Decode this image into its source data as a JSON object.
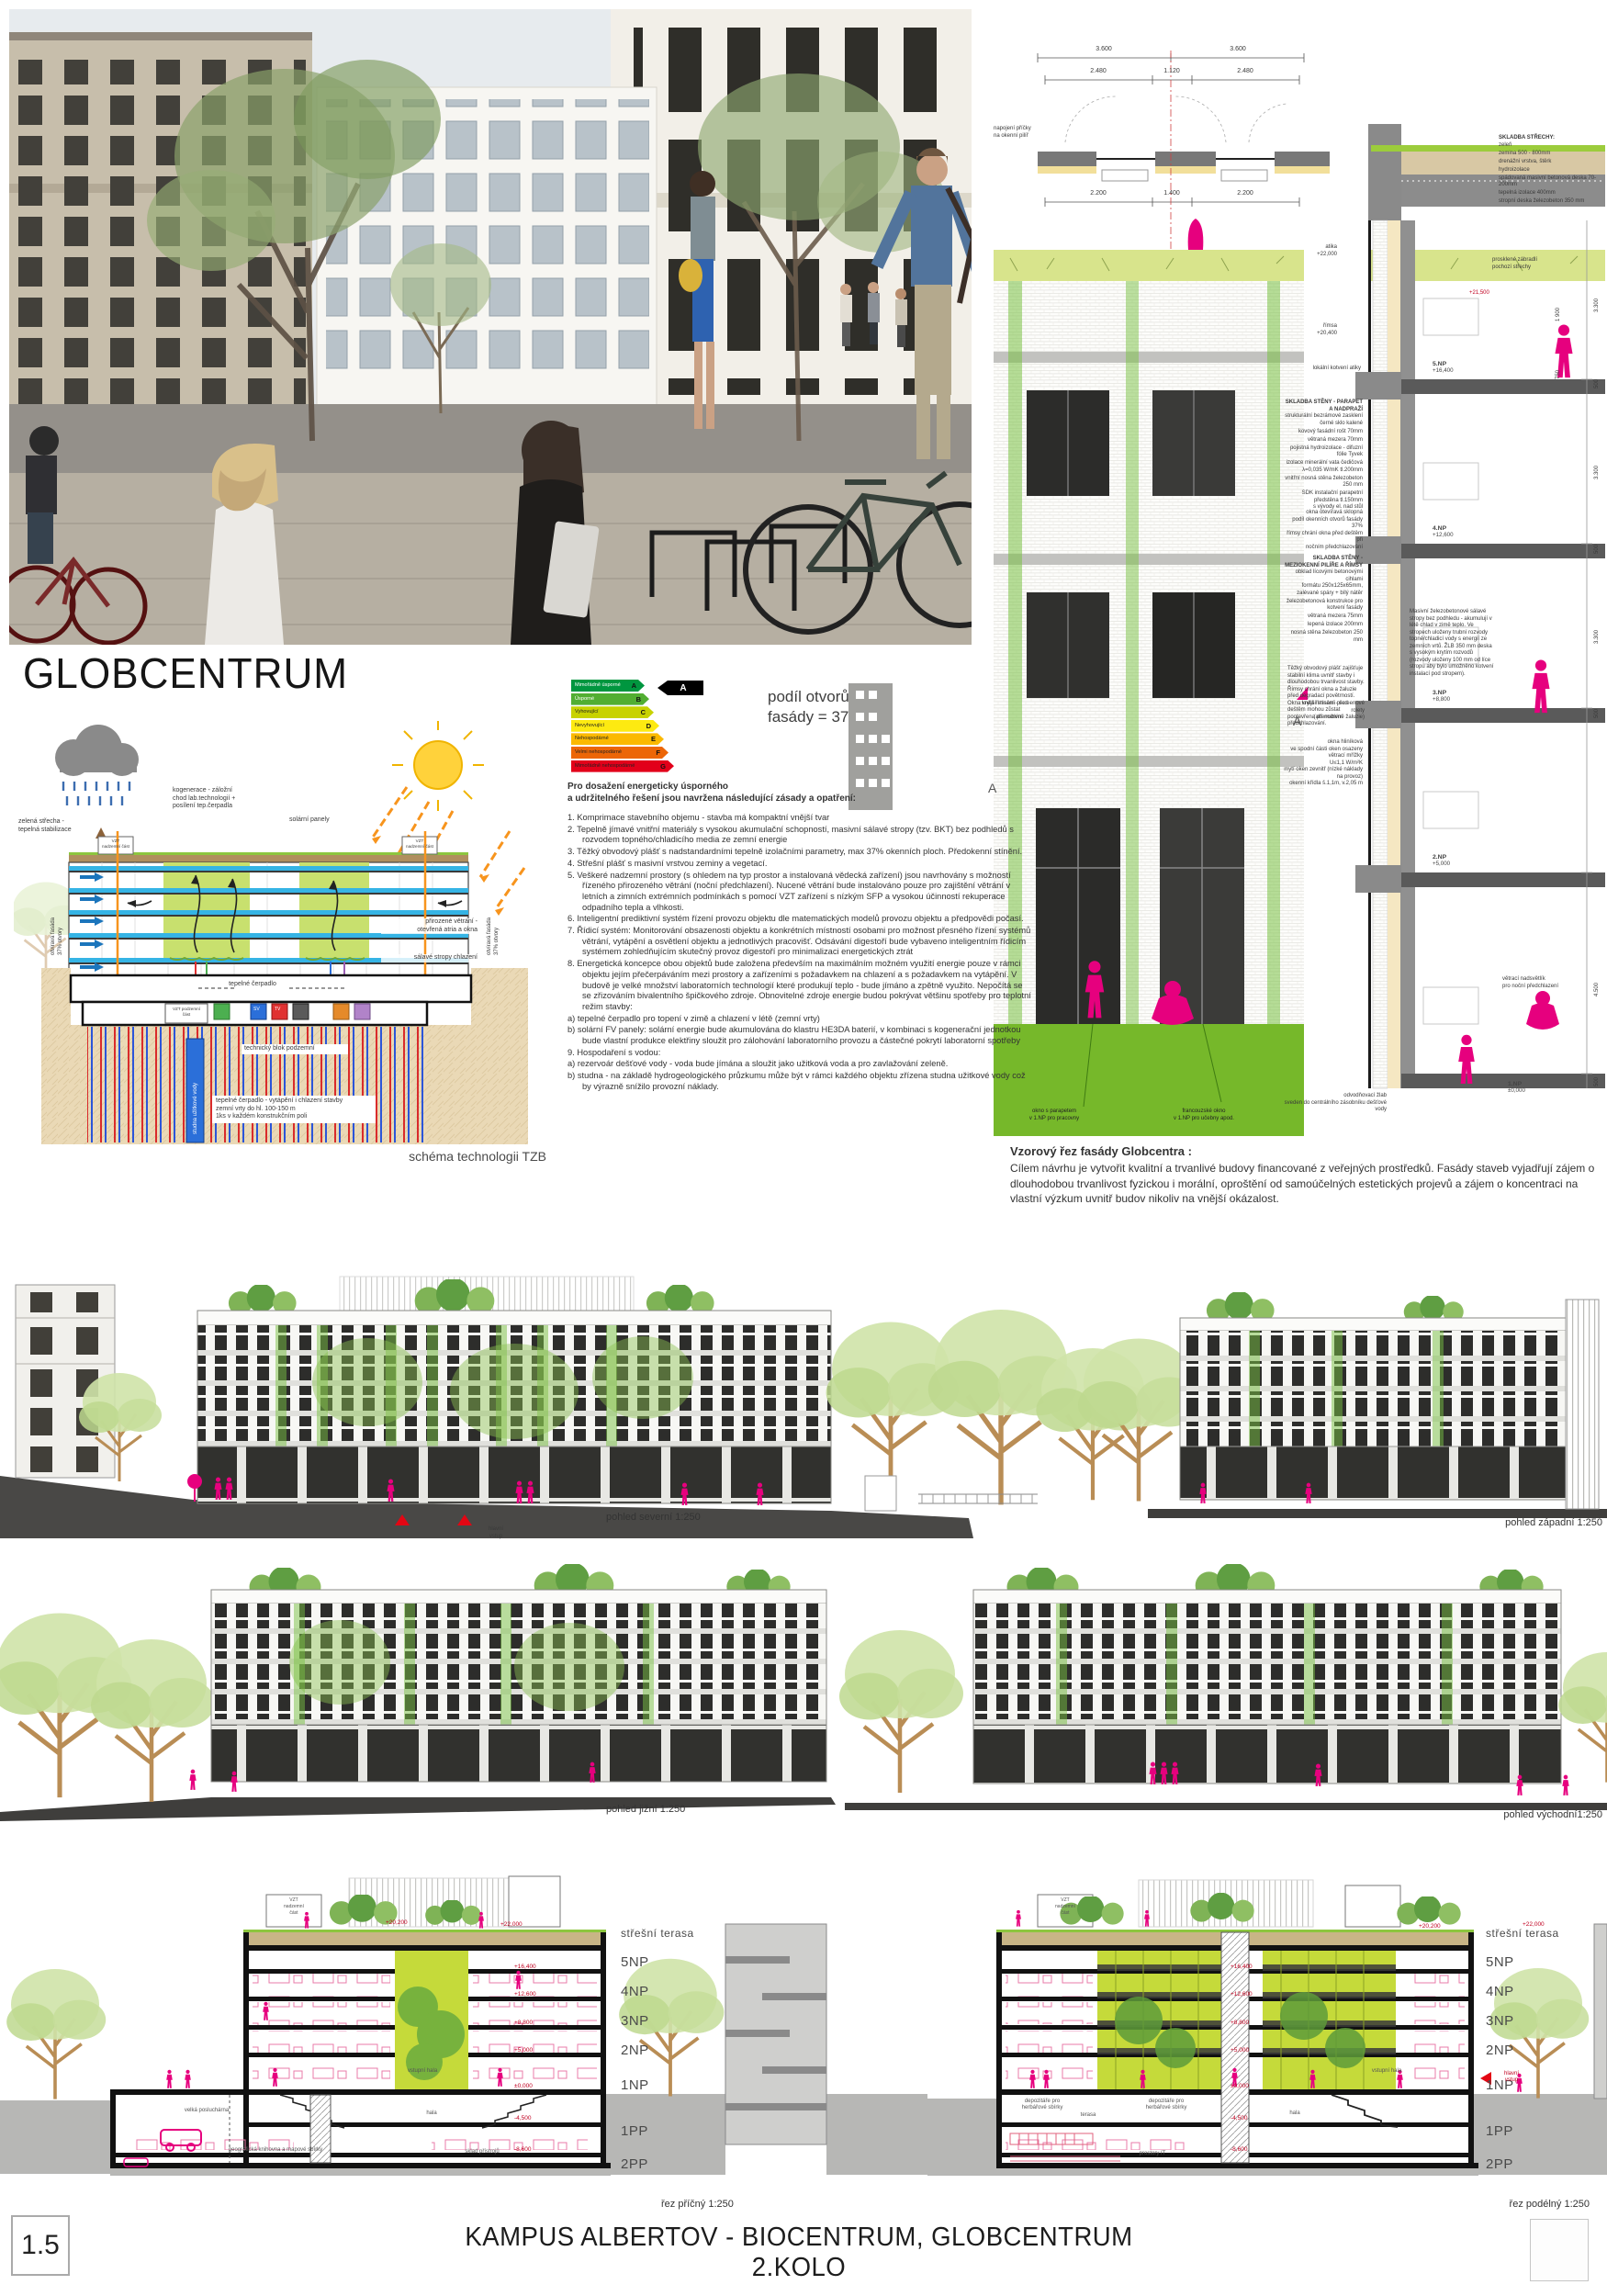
{
  "colors": {
    "accent_pink": "#e6007e",
    "grass_green": "#76b82a",
    "atrium_green": "#c5da3a",
    "tech_blue": "#35b4e5"
  },
  "board": {
    "page_number": "1.5",
    "title_line1": "KAMPUS ALBERTOV - BIOCENTRUM, GLOBCENTRUM",
    "title_line2": "2.KOLO"
  },
  "photo": {
    "sign": "GLOBCENTRUM"
  },
  "globcentrum_title": "GLOBCENTRUM",
  "energy_label": {
    "pointer_letter": "A",
    "rows": [
      {
        "label": "Mimořádně úsporné",
        "letter": "A",
        "color": "#00963f",
        "w": 80
      },
      {
        "label": "Úsporné",
        "letter": "B",
        "color": "#52ae32",
        "w": 85
      },
      {
        "label": "Vyhovující",
        "letter": "C",
        "color": "#c8d200",
        "w": 90
      },
      {
        "label": "Nevyhovující",
        "letter": "D",
        "color": "#fdea11",
        "w": 96
      },
      {
        "label": "Nehospodárné",
        "letter": "E",
        "color": "#fbb900",
        "w": 101
      },
      {
        "label": "Velmi nehospodárné",
        "letter": "F",
        "color": "#ec6607",
        "w": 106
      },
      {
        "label": "Mimořádně nehospodárné",
        "letter": "G",
        "color": "#e2001a",
        "w": 112
      }
    ]
  },
  "facade_share": {
    "line1": "podíl otvorů",
    "line2": "fasády = 37%"
  },
  "energy_text": {
    "heading_line1": "Pro dosažení energeticky úsporného",
    "heading_line2": "a udržitelného řešení jsou navržena následující zásady a opatření:",
    "items": [
      "1.  Komprimace stavebního objemu - stavba má kompaktní vnější tvar",
      "2.  Tepelně jímavé vnitřní materiály s vysokou akumulační schopností, masivní sálavé stropy (tzv. BKT) bez podhledů s rozvodem topného/chladicího media ze zemní energie",
      "3.  Těžký obvodový plášť s nadstandardními tepelně izolačními parametry, max 37% okenních ploch. Předokenní stínění.",
      "4.  Střešní plášť s masivní vrstvou zeminy a vegetací.",
      "5.  Veškeré nadzemní prostory (s ohledem na typ prostor a instalovaná vědecká zařízení) jsou navrhovány s možností řízeného přirozeného větrání (noční předchlazení). Nucené větrání bude instalováno pouze pro zajištění větrání v letních a zimních extrémních podmínkách s pomocí VZT zařízení s nízkým SFP a vysokou účinností rekuperace odpadního tepla a vlhkosti.",
      "6.  Inteligentní prediktivní systém řízení provozu objektu dle matematických modelů provozu objektu a předpovědi počasí.",
      "7.  Řídicí systém: Monitorování obsazenosti objektu a konkrétních místností osobami pro možnost přesného řízení systémů větrání, vytápění a osvětlení objektu a jednotlivých pracovišť. Odsávání digestoří bude vybaveno inteligentním řídicím systémem zohledňujícím skutečný provoz digestoří pro minimalizaci energetických ztrát",
      "8.  Energetická koncepce obou objektů bude založena především na maximálním možném využití energie pouze v rámci objektu jejím přečerpáváním mezi prostory a zařízeními s požadavkem na chlazení a s požadavkem na vytápění. V budově je velké množství laboratorních technologií které produkují teplo - bude jímáno a zpětně využito. Nepočítá se se zřizováním bivalentního špičkového zdroje. Obnovitelné zdroje energie budou pokrývat většinu spotřeby pro teplotní režim stavby:",
      "a) tepelné čerpadlo pro topení v zimě a chlazení v létě (zemní vrty)",
      "b) solární FV panely: solární energie bude akumulována do klastru HE3DA baterií, v kombinaci s kogenerační jednotkou bude vlastní produkce elektřiny sloužit pro zálohování laboratorního provozu a částečné pokrytí laboratorní spotřeby",
      "9.  Hospodaření s vodou:",
      "a) rezervoár dešťové vody - voda bude jímána a sloužit jako užitková voda a pro zavlažování zeleně.",
      "b) studna - na základě hydrogeologického průzkumu může být v rámci každého objektu zřízena studna užitkové vody což by výrazně snížilo provozní náklady."
    ]
  },
  "tzb": {
    "caption": "schéma technologii TZB",
    "green_roof": "zelená střecha -\ntepelná stabilizace",
    "cogen": "kogenerace - záložní\nchod lab.technologií +\nposílení tep.čerpadla",
    "solar": "solární panely",
    "vzt_top": "VZT\nnadzemní část",
    "nat_vent": "přirozené větrání -\notevřená atria a okna",
    "slabs": "sálavé stropy chlazení",
    "heat_pump": "tepelné čerpadlo",
    "vzt_bottom": "VZT podzemní\nčást",
    "tech_block": "technický blok podzemní",
    "well": "studna užitkové vody",
    "boreholes": "tepelné čerpadlo - vytápění i chlazení stavby\nzemní vrty do hl. 100-150 m\n1ks v každém konstrukčním poli",
    "facade_side": "otvíravá fasáda\n37% otvory",
    "box_sv": "SV",
    "box_tv": "TV"
  },
  "facade_detail": {
    "plan": {
      "dims_row1": [
        "3.600",
        "3.600"
      ],
      "dims_row2": [
        "2.480",
        "1.120",
        "2.480"
      ],
      "dims_row3": [
        "2.200",
        "1.400",
        "2.200"
      ],
      "note": "napojení příčky\nna okenní pilíř"
    },
    "roof": {
      "title": "SKLADBA STŘECHY:",
      "layers": [
        "zeleň",
        "zemina 500 - 800mm",
        "drenážní vrstva, štěrk",
        "hydroizolace",
        "spádovaná masivní betonová deska 70-200mm",
        "tepelná izolace 400mm",
        "stropní deska železobeton 350 mm"
      ]
    },
    "parapet_note": "prosklené zábradlí\npochozí střechy",
    "terrace_level": "+21,500",
    "anchor_note": "lokální kotvení atiky",
    "levels": {
      "atika": {
        "name": "atika",
        "value": "+22,000"
      },
      "rimsa": {
        "name": "římsa",
        "value": "+20,400"
      },
      "np5": {
        "name": "5.NP",
        "value": "+16,400"
      },
      "np4": {
        "name": "4.NP",
        "value": "+12,600"
      },
      "np3": {
        "name": "3.NP",
        "value": "+8,800"
      },
      "np2": {
        "name": "2.NP",
        "value": "+5,000"
      },
      "np1": {
        "name": "1.NP",
        "value": "±0,000"
      }
    },
    "wall1": {
      "title": "SKLADBA STĚNY - PARAPET A NADPRAŽÍ",
      "layers": [
        "strukturální bezrámové zasklení\nčerné sklo kalené",
        "kovový fasádní rošt 70mm",
        "větraná mezera 70mm",
        "pojistná hydroizolace - difuzní fólie Tyvek",
        "izolace minerální vata čedičová\nλ=0,035 W/mK tl.200mm",
        "vnitřní nosná stěna železobeton 250 mm",
        "SDK instalační parapetní předstěna tl.150mm\ns vývody el. nad stůl"
      ]
    },
    "window_note": "okna otevíravá sklopná\npodíl okenních otvorů fasády 37%\nřímsy chrání okna před deštěm při\nnočním předchlazování",
    "wall2": {
      "title": "SKLADBA STĚNY -\nMEZIOKENNÍ PILÍŘE A ŘÍMSY",
      "layers": [
        "obklad lícovými betonovými cihlami\nformátu 250x125x65mm,\nzalévané spáry + bílý nátěr",
        "železobetonová konstrukce pro kotvení fasády",
        "větraná mezera 75mm",
        "lepená izolace 200mm",
        "nosná stěna železobeton 250 mm"
      ]
    },
    "envelope_note": "Těžký obvodový plášť zajišťuje stabilní klima uvnitř stavby i dlouhodobou trvanlivost stavby. Římsy chrání okna a žaluzie před degradací povětrností. Okna krytá římsami před deštěm mohou zůstat pootevřena při nočním předchlazování.",
    "slab_note": "Masivní železobetonové sálavé stropy bez podhledu - akumulují v létě chlad v zimě teplo. Ve stropech uloženy trubní rozvody topné/chladicí vody s energií ze zemních vrtů. ŽLB 350 mm deska s vysokým krytím rozvodů (rozvody uloženy 100 mm od líce stropu aby bylo umožněno kotvení instalací pod stropem).",
    "shading_note": "vnější stínění - screenové rolety\n(alternativně žaluzie)",
    "window_spec": "okna hliníková\nve spodní části oken osazeny větrací mřížky\nU≤1,1 W/m²K\nmytí oken zevnitř (nízké náklady na provoz)\nokenní křídla š.1,1m, v.2,05 m",
    "vent_note": "větrací nadsvětlík\npro noční předchlazení",
    "drain_note": "odvodňovací žlab\nsveden do centrálního zásobníku dešťové vody",
    "ground_notes": [
      "okno s parapetem\nv 1.NP pro pracovny",
      "francouzské okno\nv 1.NP pro učebny apod."
    ],
    "section_marker": "A",
    "dims_right": [
      "3.300",
      "500",
      "3.300",
      "500",
      "3.300",
      "500",
      "4.500",
      "500"
    ],
    "dims_small": [
      "1 900",
      "750"
    ]
  },
  "vzor_text": {
    "heading": "Vzorový řez fasády Globcentra :",
    "body": "Cílem návrhu je vytvořit kvalitní a trvanlivé budovy financované z veřejných prostředků. Fasády staveb vyjadřují zájem o dlouhodobou trvanlivost fyzickou i morální, oproštění od samoúčelných estetických projevů a zájem o koncentraci na vlastní výzkum uvnitř budov nikoliv na vnější okázalost."
  },
  "elevations": {
    "north_caption": "pohled severní 1:250",
    "west_caption": "pohled západní 1:250",
    "south_caption": "pohled jižní 1:250",
    "east_caption": "pohled východní1:250",
    "entry_label": "hlavní\nvstup"
  },
  "sections": {
    "left_caption": "řez příčný 1:250",
    "right_caption": "řez podélný 1:250",
    "roof_label": "střešní terasa",
    "floors": [
      "5NP",
      "4NP",
      "3NP",
      "2NP",
      "1NP",
      "1PP",
      "2PP"
    ],
    "marks": [
      "+22,000",
      "+20,200",
      "+16,400",
      "+12,600",
      "+8,800",
      "+5,000",
      "±0,000",
      "-4,500",
      "-8,600"
    ],
    "vzt_label": "VZT\nnadzemní\nčást",
    "rooms_left": [
      "velká posluchárna",
      "vstupní hala",
      "hala",
      "geografická knihovna a mapové sbírky",
      "sklad přístrojů"
    ],
    "rooms_right": [
      "terasa",
      "vstupní hala",
      "hala",
      "depozitáře pro\nherbářové sbírky",
      "depozitáře pro\nherbářové sbírky",
      "prostory IT"
    ],
    "entry_label": "hlavní\nvstup"
  }
}
